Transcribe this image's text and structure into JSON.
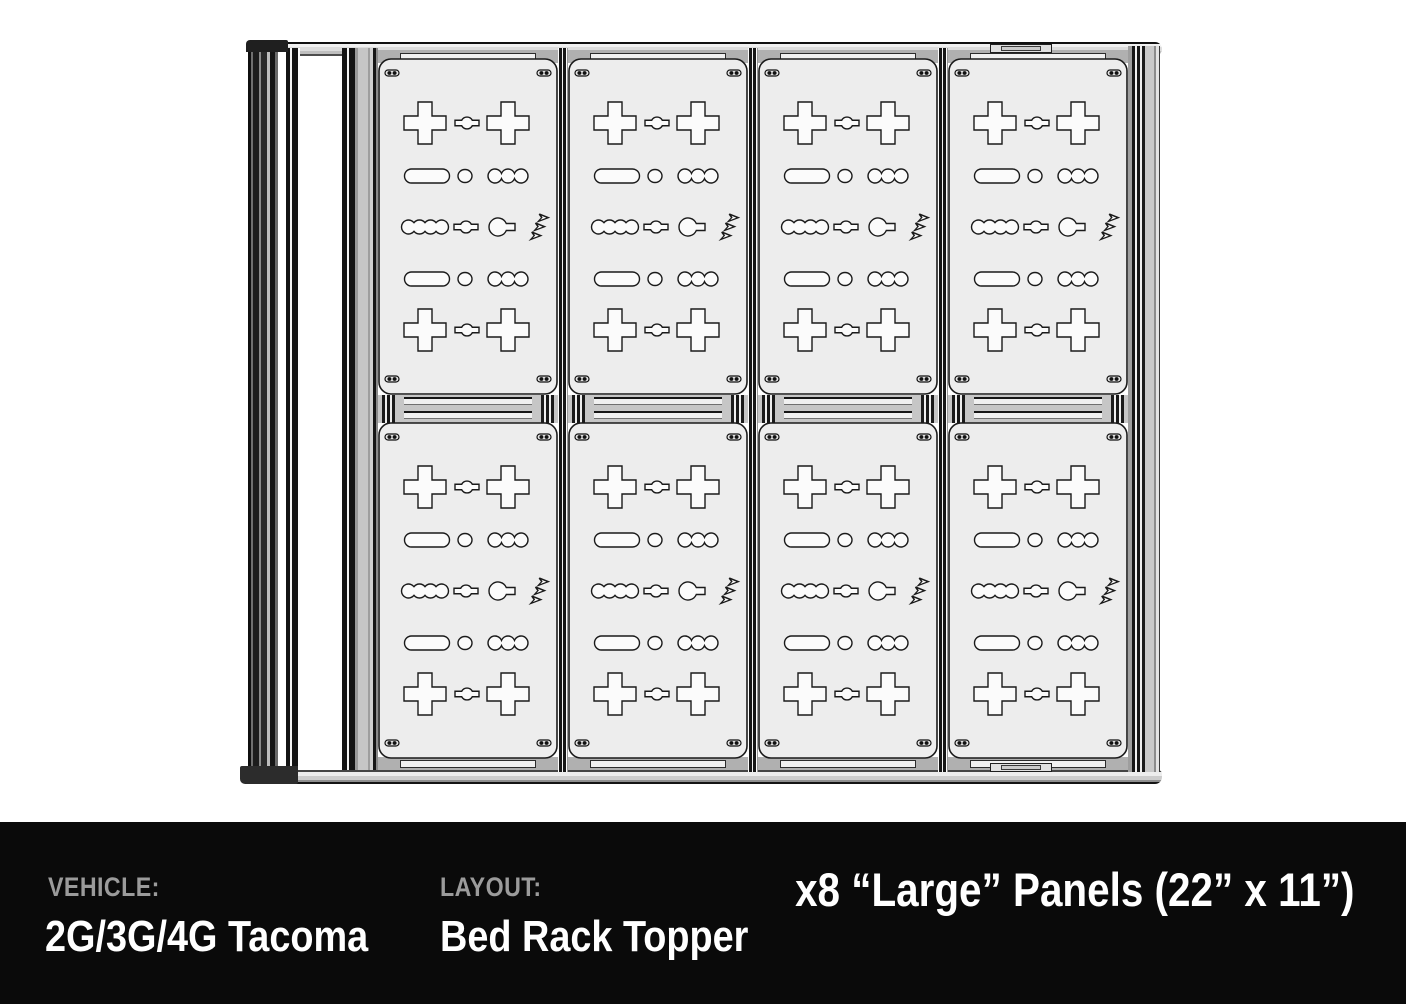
{
  "diagram": {
    "rack": {
      "rows": 2,
      "columns": 4,
      "panel_count": 8,
      "panel_rows": [
        [
          "plus",
          "bone",
          "plus"
        ],
        [
          "pill",
          "circle",
          "scallop3"
        ],
        [
          "scallop4",
          "bone",
          "keyhole",
          "logo"
        ],
        [
          "pill",
          "circle",
          "scallop3"
        ],
        [
          "plus",
          "bone",
          "plus"
        ]
      ],
      "fasteners_per_panel": 4
    },
    "colors": {
      "panel_fill": "#ededed",
      "cutout_fill": "#fbfbfb",
      "outline": "#1a1a1a",
      "rail_gray": "#c6c6c6",
      "background": "#ffffff"
    }
  },
  "footer": {
    "background": "#0a0a0a",
    "label_color": "#9b9b9b",
    "value_color": "#ffffff",
    "vehicle_label": "VEHICLE:",
    "vehicle_value": "2G/3G/4G Tacoma",
    "layout_label": "LAYOUT:",
    "layout_value": "Bed Rack Topper",
    "panels_note": "x8 “Large” Panels (22” x 11”)"
  }
}
